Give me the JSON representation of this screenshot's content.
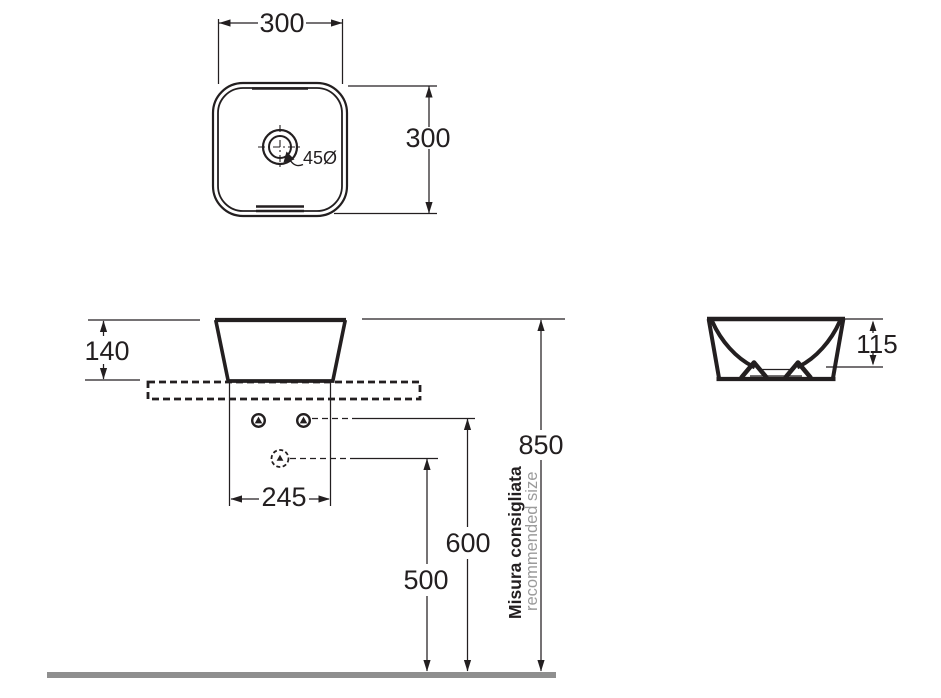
{
  "top_view": {
    "width_label": "300",
    "depth_label": "300",
    "drain_label": "45Ø"
  },
  "front_view": {
    "height_label": "140",
    "holes_span_label": "245"
  },
  "heights": {
    "rim_label": "850",
    "mid_label": "600",
    "low_label": "500"
  },
  "side_view": {
    "depth_label": "115"
  },
  "note": {
    "line1": "Misura consigliata",
    "line2": "recommended size"
  },
  "colors": {
    "line": "#231f20",
    "note_gray": "#9b9b9b",
    "ground": "#8f8f8f"
  }
}
